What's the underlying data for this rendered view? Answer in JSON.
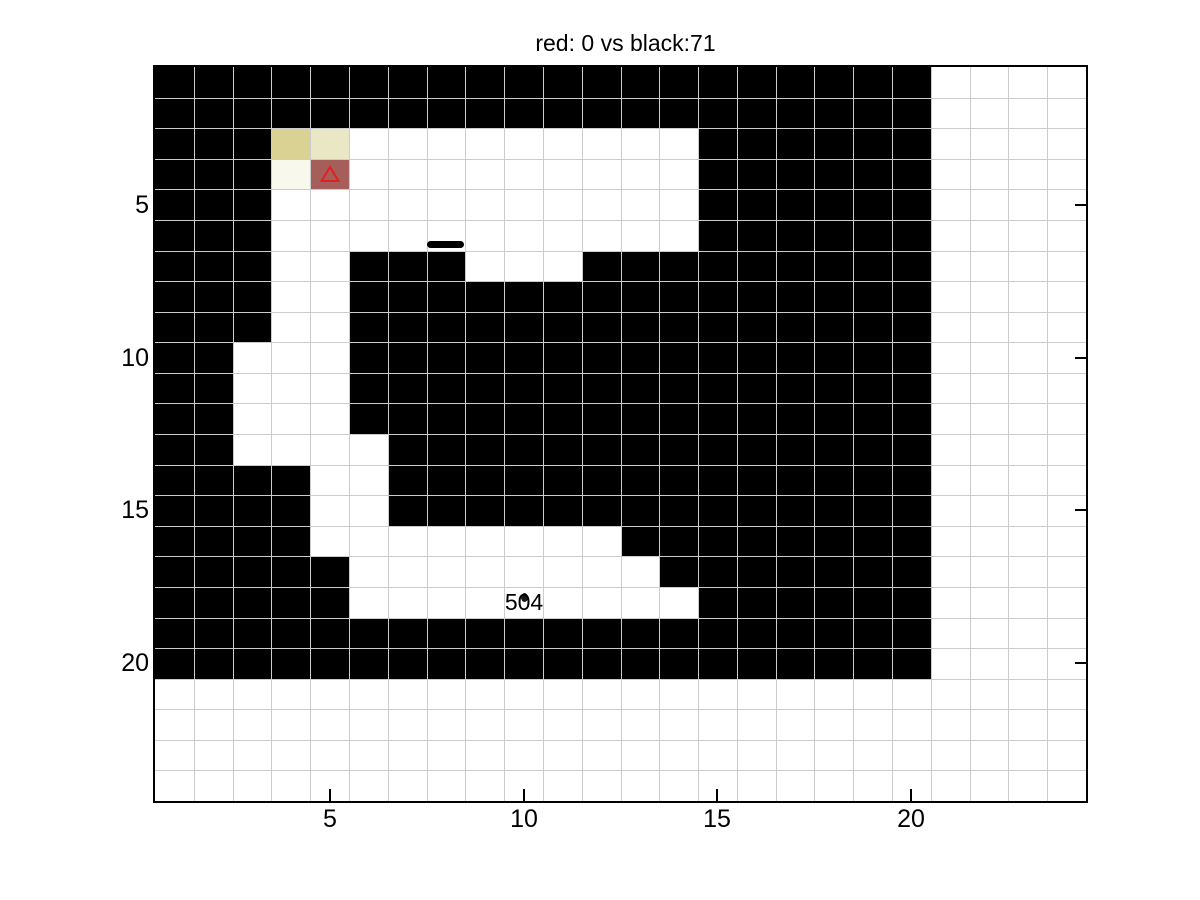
{
  "title": "red: 0 vs black:71",
  "axes": {
    "x_tick_labels": [
      "5",
      "10",
      "15",
      "20"
    ],
    "x_tick_values": [
      5,
      10,
      15,
      20
    ],
    "y_tick_labels": [
      "5",
      "10",
      "15",
      "20"
    ],
    "y_tick_values": [
      5,
      10,
      15,
      20
    ]
  },
  "chart_data": {
    "type": "heatmap",
    "title": "red: 0 vs black:71",
    "grid_cols": 24,
    "grid_rows": 24,
    "xlim": [
      0.5,
      24.5
    ],
    "ylim": [
      0.5,
      24.5
    ],
    "y_direction": "down",
    "grid": "on",
    "gridline_color": "#cccccc",
    "wall_color": "#000000",
    "free_color": "#ffffff",
    "maze_rows": [
      "11111111111111111111",
      "11111111111111111111",
      "11100000000000111111",
      "11100000000000111111",
      "11100000000000111111",
      "11100000000000111111",
      "11100111000111111111",
      "11100111111111111111",
      "11100111111111111111",
      "11000111111111111111",
      "11000111111111111111",
      "11000111111111111111",
      "11000011111111111111",
      "11110011111111111111",
      "11110011111111111111",
      "11110000000011111111",
      "11111000000001111111",
      "11111000000000111111",
      "11111111111111111111",
      "11111111111111111111"
    ],
    "special_cells": [
      {
        "col": 4,
        "row": 3,
        "color": "#d9d292"
      },
      {
        "col": 5,
        "row": 3,
        "color": "#eae8c4"
      },
      {
        "col": 4,
        "row": 4,
        "color": "#f9f8ed"
      },
      {
        "col": 5,
        "row": 4,
        "color": "#a55e5a"
      }
    ],
    "marker": {
      "shape": "triangle-up-outline",
      "col": 5,
      "row": 4,
      "color": "#e02020"
    },
    "path_segment": {
      "from_x": 7.5,
      "to_x": 8.45,
      "y": 6.3,
      "color": "#000000"
    },
    "text_label": {
      "text": "504",
      "x": 10,
      "y": 18,
      "color": "#000000"
    }
  }
}
